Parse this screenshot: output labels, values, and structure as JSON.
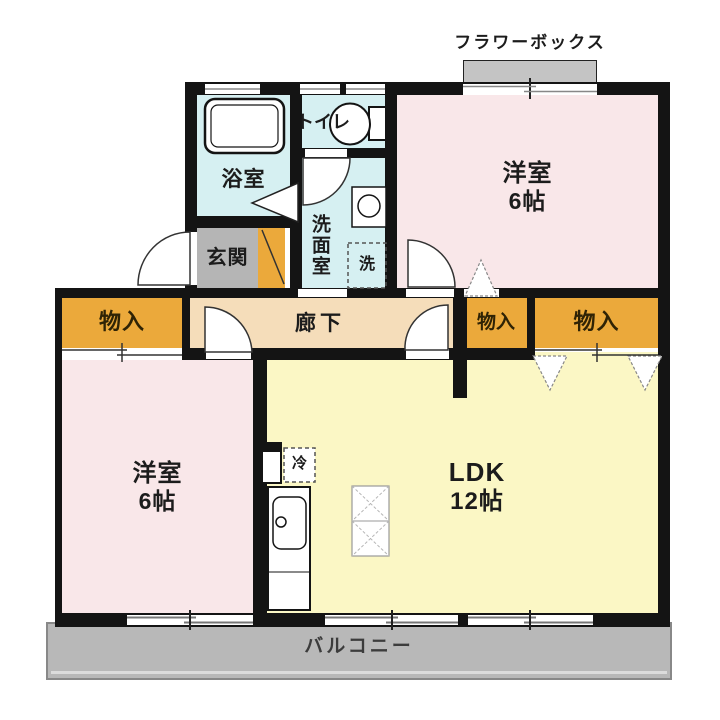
{
  "plan": {
    "flower_box_label": "フラワーボックス",
    "balcony_label": "バルコニー",
    "rooms": {
      "bath": "浴室",
      "toilet": "トイレ",
      "washroom": "洗面室",
      "entrance": "玄関",
      "hallway": "廊下",
      "storage_left": "物入",
      "storage_mid": "物入",
      "storage_right": "物入",
      "bedroom_top": {
        "name": "洋室",
        "size": "6帖"
      },
      "bedroom_left": {
        "name": "洋室",
        "size": "6帖"
      },
      "ldk": {
        "name": "LDK",
        "size": "12帖"
      }
    },
    "fixtures": {
      "refrigerator": "冷",
      "washer": "洗"
    },
    "colors": {
      "wall": "#141414",
      "western_room": "#f9e7e9",
      "ldk_room": "#fbf7c5",
      "wet_area": "#d6f0f2",
      "storage": "#eba93b",
      "entrance": "#b5b5b5",
      "hallway": "#f5ddba",
      "balcony": "#b8b8b8",
      "flower_box": "#c4c4c4"
    }
  }
}
